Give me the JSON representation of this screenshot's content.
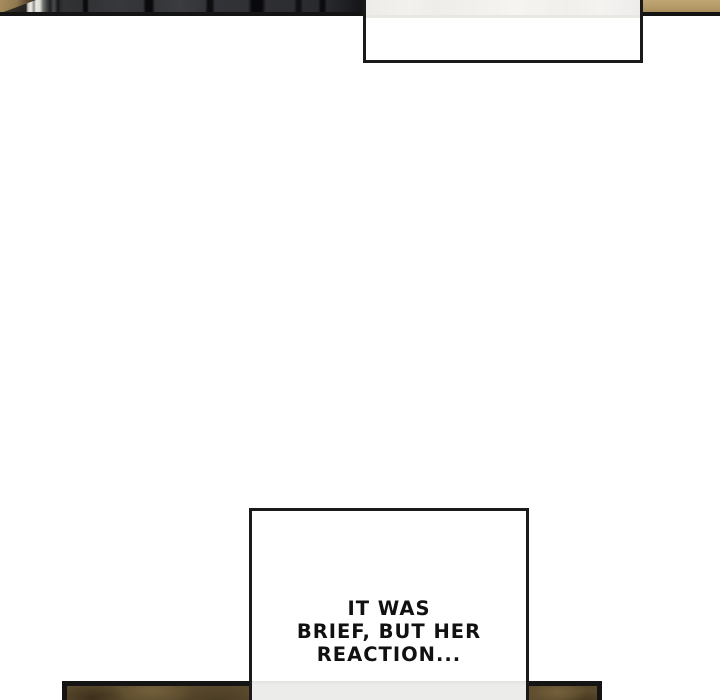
{
  "comic": {
    "bubble_top": {
      "text": ""
    },
    "bubble_bottom": {
      "lines": [
        "IT WAS",
        "BRIEF, BUT HER",
        "REACTION..."
      ]
    },
    "colors": {
      "page_background": "#ffffff",
      "panel_border": "#141414",
      "bubble_border": "#1a1a1a",
      "speech_text": "#111111",
      "tan_wall": "#b59b69",
      "bottom_panel_base": "#5a4a2d",
      "bubble_shade": "#f1efec",
      "overlap_shade": "#ebebe9"
    }
  }
}
